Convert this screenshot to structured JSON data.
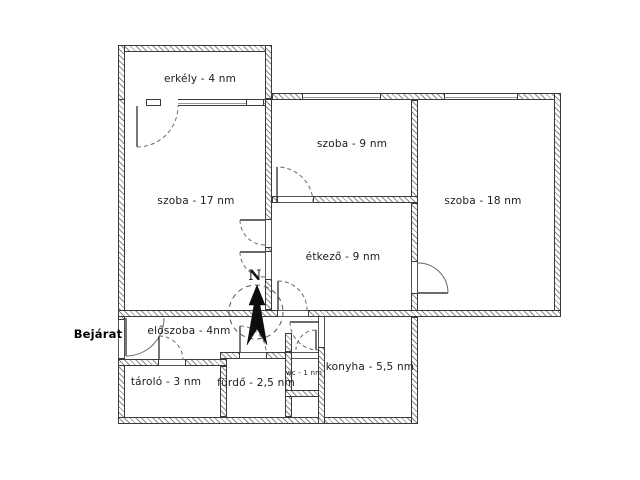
{
  "floorplan": {
    "colors": {
      "background": "#ffffff",
      "wall_line": "#3a3a3a",
      "hatch": "#8a8a8a",
      "text": "#1c1c1c"
    },
    "entrance_label": "Bejárat",
    "compass_label": "N",
    "rooms": [
      {
        "name": "erkely",
        "label": "erkély - 4 nm"
      },
      {
        "name": "szoba-17",
        "label": "szoba - 17 nm"
      },
      {
        "name": "szoba-9",
        "label": "szoba - 9 nm"
      },
      {
        "name": "szoba-18",
        "label": "szoba - 18 nm"
      },
      {
        "name": "etkezo",
        "label": "étkező - 9 nm"
      },
      {
        "name": "eloszoba",
        "label": "előszoba - 4nm"
      },
      {
        "name": "tarolo",
        "label": "tároló - 3 nm"
      },
      {
        "name": "furdo",
        "label": "fürdő - 2,5 nm"
      },
      {
        "name": "wc",
        "label": "wc - 1 nm"
      },
      {
        "name": "konyha",
        "label": "konyha - 5,5 nm"
      }
    ]
  }
}
